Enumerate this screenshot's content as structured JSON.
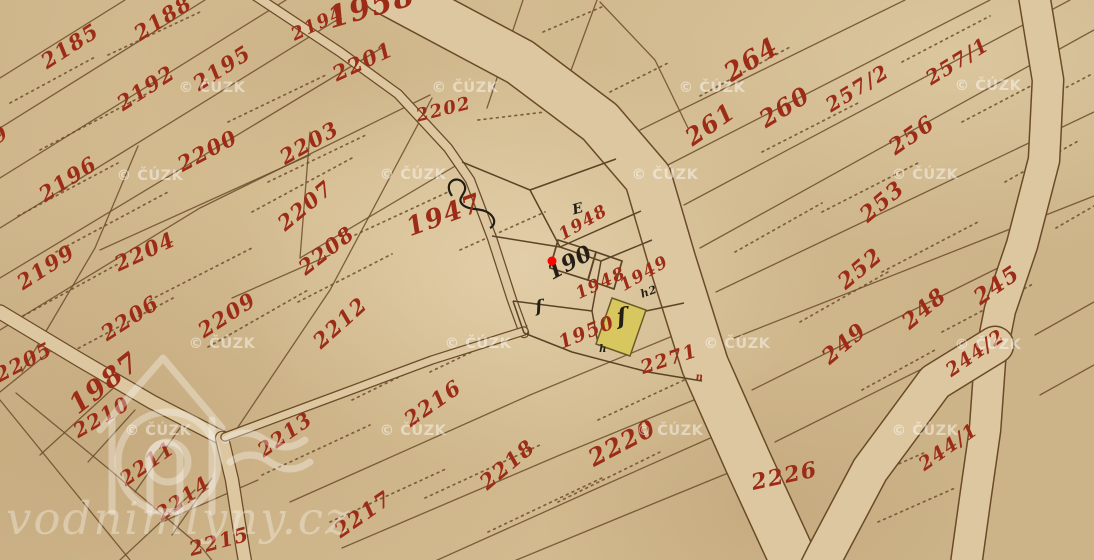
{
  "map": {
    "canvas": {
      "width": 1094,
      "height": 560
    },
    "colors": {
      "paper": "#d5bd92",
      "road_fill": "#dcc7a0",
      "line_brown": "#6b4c2b",
      "ink_red": "#9c2c17",
      "ink_black": "#241e15",
      "building_yellow": "#d8c75f",
      "marker_red": "#f50800",
      "watermark_white": "rgba(255,255,255,0.45)"
    },
    "parcel_labels": [
      {
        "text": "2185",
        "x": 74,
        "y": 52,
        "rot": -33,
        "size": 21,
        "ink": "red"
      },
      {
        "text": "2188",
        "x": 167,
        "y": 24,
        "rot": -33,
        "size": 21,
        "ink": "red"
      },
      {
        "text": "2192",
        "x": 150,
        "y": 94,
        "rot": -33,
        "size": 21,
        "ink": "red"
      },
      {
        "text": "2195",
        "x": 226,
        "y": 74,
        "rot": -33,
        "size": 21,
        "ink": "red"
      },
      {
        "text": "2194",
        "x": 320,
        "y": 29,
        "rot": -25,
        "size": 18,
        "ink": "red"
      },
      {
        "text": "9",
        "x": 4,
        "y": 140,
        "rot": -33,
        "size": 20,
        "ink": "red"
      },
      {
        "text": "2196",
        "x": 72,
        "y": 185,
        "rot": -33,
        "size": 21,
        "ink": "red"
      },
      {
        "text": "2199",
        "x": 50,
        "y": 273,
        "rot": -33,
        "size": 21,
        "ink": "red"
      },
      {
        "text": "2200",
        "x": 211,
        "y": 157,
        "rot": -28,
        "size": 21,
        "ink": "red"
      },
      {
        "text": "2203",
        "x": 313,
        "y": 149,
        "rot": -30,
        "size": 21,
        "ink": "red"
      },
      {
        "text": "2201",
        "x": 366,
        "y": 68,
        "rot": -25,
        "size": 21,
        "ink": "red"
      },
      {
        "text": "2202",
        "x": 445,
        "y": 115,
        "rot": -14,
        "size": 18,
        "ink": "red"
      },
      {
        "text": "2204",
        "x": 148,
        "y": 258,
        "rot": -25,
        "size": 21,
        "ink": "red"
      },
      {
        "text": "2206",
        "x": 134,
        "y": 324,
        "rot": -33,
        "size": 21,
        "ink": "red"
      },
      {
        "text": "2207",
        "x": 310,
        "y": 211,
        "rot": -40,
        "size": 21,
        "ink": "red"
      },
      {
        "text": "2208",
        "x": 331,
        "y": 256,
        "rot": -38,
        "size": 21,
        "ink": "red"
      },
      {
        "text": "2209",
        "x": 231,
        "y": 321,
        "rot": -33,
        "size": 21,
        "ink": "red"
      },
      {
        "text": "2212",
        "x": 345,
        "y": 328,
        "rot": -42,
        "size": 21,
        "ink": "red"
      },
      {
        "text": "2205",
        "x": 27,
        "y": 368,
        "rot": -28,
        "size": 20,
        "ink": "red"
      },
      {
        "text": "1987",
        "x": 110,
        "y": 390,
        "rot": -38,
        "size": 27,
        "ink": "red"
      },
      {
        "text": "2210",
        "x": 105,
        "y": 423,
        "rot": -30,
        "size": 20,
        "ink": "red"
      },
      {
        "text": "2211",
        "x": 151,
        "y": 469,
        "rot": -35,
        "size": 20,
        "ink": "red"
      },
      {
        "text": "2214",
        "x": 187,
        "y": 504,
        "rot": -35,
        "size": 20,
        "ink": "red"
      },
      {
        "text": "2215",
        "x": 221,
        "y": 548,
        "rot": -15,
        "size": 20,
        "ink": "red"
      },
      {
        "text": "2213",
        "x": 289,
        "y": 440,
        "rot": -35,
        "size": 20,
        "ink": "red"
      },
      {
        "text": "2216",
        "x": 437,
        "y": 409,
        "rot": -35,
        "size": 21,
        "ink": "red"
      },
      {
        "text": "2217",
        "x": 367,
        "y": 520,
        "rot": -35,
        "size": 21,
        "ink": "red"
      },
      {
        "text": "2218",
        "x": 512,
        "y": 470,
        "rot": -40,
        "size": 21,
        "ink": "red"
      },
      {
        "text": "2220",
        "x": 626,
        "y": 450,
        "rot": -28,
        "size": 24,
        "ink": "red"
      },
      {
        "text": "2226",
        "x": 786,
        "y": 483,
        "rot": -12,
        "size": 22,
        "ink": "red"
      },
      {
        "text": "2271",
        "x": 671,
        "y": 365,
        "rot": -18,
        "size": 19,
        "ink": "red"
      },
      {
        "text": "1958",
        "x": 374,
        "y": 16,
        "rot": -16,
        "size": 30,
        "ink": "red"
      },
      {
        "text": "1947",
        "x": 447,
        "y": 223,
        "rot": -20,
        "size": 26,
        "ink": "red"
      },
      {
        "text": "1948",
        "x": 586,
        "y": 227,
        "rot": -30,
        "size": 17,
        "ink": "red"
      },
      {
        "text": "1948",
        "x": 603,
        "y": 288,
        "rot": -25,
        "size": 17,
        "ink": "red"
      },
      {
        "text": "1949",
        "x": 647,
        "y": 278,
        "rot": -30,
        "size": 17,
        "ink": "red"
      },
      {
        "text": "1950",
        "x": 589,
        "y": 338,
        "rot": -22,
        "size": 19,
        "ink": "red"
      },
      {
        "text": "190",
        "x": 573,
        "y": 269,
        "rot": -28,
        "size": 22,
        "ink": "black"
      },
      {
        "text": "264",
        "x": 756,
        "y": 67,
        "rot": -32,
        "size": 26,
        "ink": "red"
      },
      {
        "text": "261",
        "x": 715,
        "y": 131,
        "rot": -35,
        "size": 24,
        "ink": "red"
      },
      {
        "text": "260",
        "x": 789,
        "y": 114,
        "rot": -32,
        "size": 24,
        "ink": "red"
      },
      {
        "text": "257/2",
        "x": 861,
        "y": 94,
        "rot": -32,
        "size": 20,
        "ink": "red"
      },
      {
        "text": "257/1",
        "x": 961,
        "y": 67,
        "rot": -32,
        "size": 20,
        "ink": "red"
      },
      {
        "text": "256",
        "x": 916,
        "y": 141,
        "rot": -35,
        "size": 22,
        "ink": "red"
      },
      {
        "text": "253",
        "x": 887,
        "y": 207,
        "rot": -40,
        "size": 22,
        "ink": "red"
      },
      {
        "text": "252",
        "x": 865,
        "y": 274,
        "rot": -40,
        "size": 22,
        "ink": "red"
      },
      {
        "text": "249",
        "x": 849,
        "y": 349,
        "rot": -40,
        "size": 22,
        "ink": "red"
      },
      {
        "text": "248",
        "x": 929,
        "y": 314,
        "rot": -40,
        "size": 22,
        "ink": "red"
      },
      {
        "text": "245",
        "x": 1001,
        "y": 291,
        "rot": -35,
        "size": 22,
        "ink": "red"
      },
      {
        "text": "244/2",
        "x": 979,
        "y": 358,
        "rot": -35,
        "size": 19,
        "ink": "red"
      },
      {
        "text": "244/1",
        "x": 952,
        "y": 452,
        "rot": -35,
        "size": 19,
        "ink": "red"
      }
    ],
    "ink_marks": [
      {
        "text": "ſ",
        "x": 540,
        "y": 312,
        "rot": -8,
        "size": 17,
        "ink": "black"
      },
      {
        "text": "ſ",
        "x": 623,
        "y": 324,
        "rot": -8,
        "size": 23,
        "ink": "black"
      },
      {
        "text": "h2",
        "x": 650,
        "y": 295,
        "rot": -20,
        "size": 11,
        "ink": "black"
      },
      {
        "text": "h",
        "x": 603,
        "y": 352,
        "rot": 0,
        "size": 10,
        "ink": "black"
      },
      {
        "text": "n",
        "x": 700,
        "y": 380,
        "rot": 0,
        "size": 10,
        "ink": "red"
      },
      {
        "text": "E",
        "x": 579,
        "y": 213,
        "rot": -15,
        "size": 14,
        "ink": "black"
      }
    ],
    "marker": {
      "name": "selected-point",
      "x": 552,
      "y": 261,
      "color": "#f50800"
    },
    "watermarks": {
      "cuzk": {
        "text": "© ČÚZK",
        "positions": [
          [
            212,
            92
          ],
          [
            465,
            92
          ],
          [
            712,
            92
          ],
          [
            988,
            90
          ],
          [
            150,
            180
          ],
          [
            413,
            179
          ],
          [
            665,
            179
          ],
          [
            925,
            179
          ],
          [
            222,
            348
          ],
          [
            478,
            348
          ],
          [
            737,
            348
          ],
          [
            988,
            349
          ],
          [
            158,
            435
          ],
          [
            413,
            435
          ],
          [
            670,
            435
          ],
          [
            925,
            435
          ]
        ]
      },
      "site": {
        "text": "vodnimlyny.cz",
        "x": 6,
        "y": 534,
        "size": 45
      }
    }
  }
}
